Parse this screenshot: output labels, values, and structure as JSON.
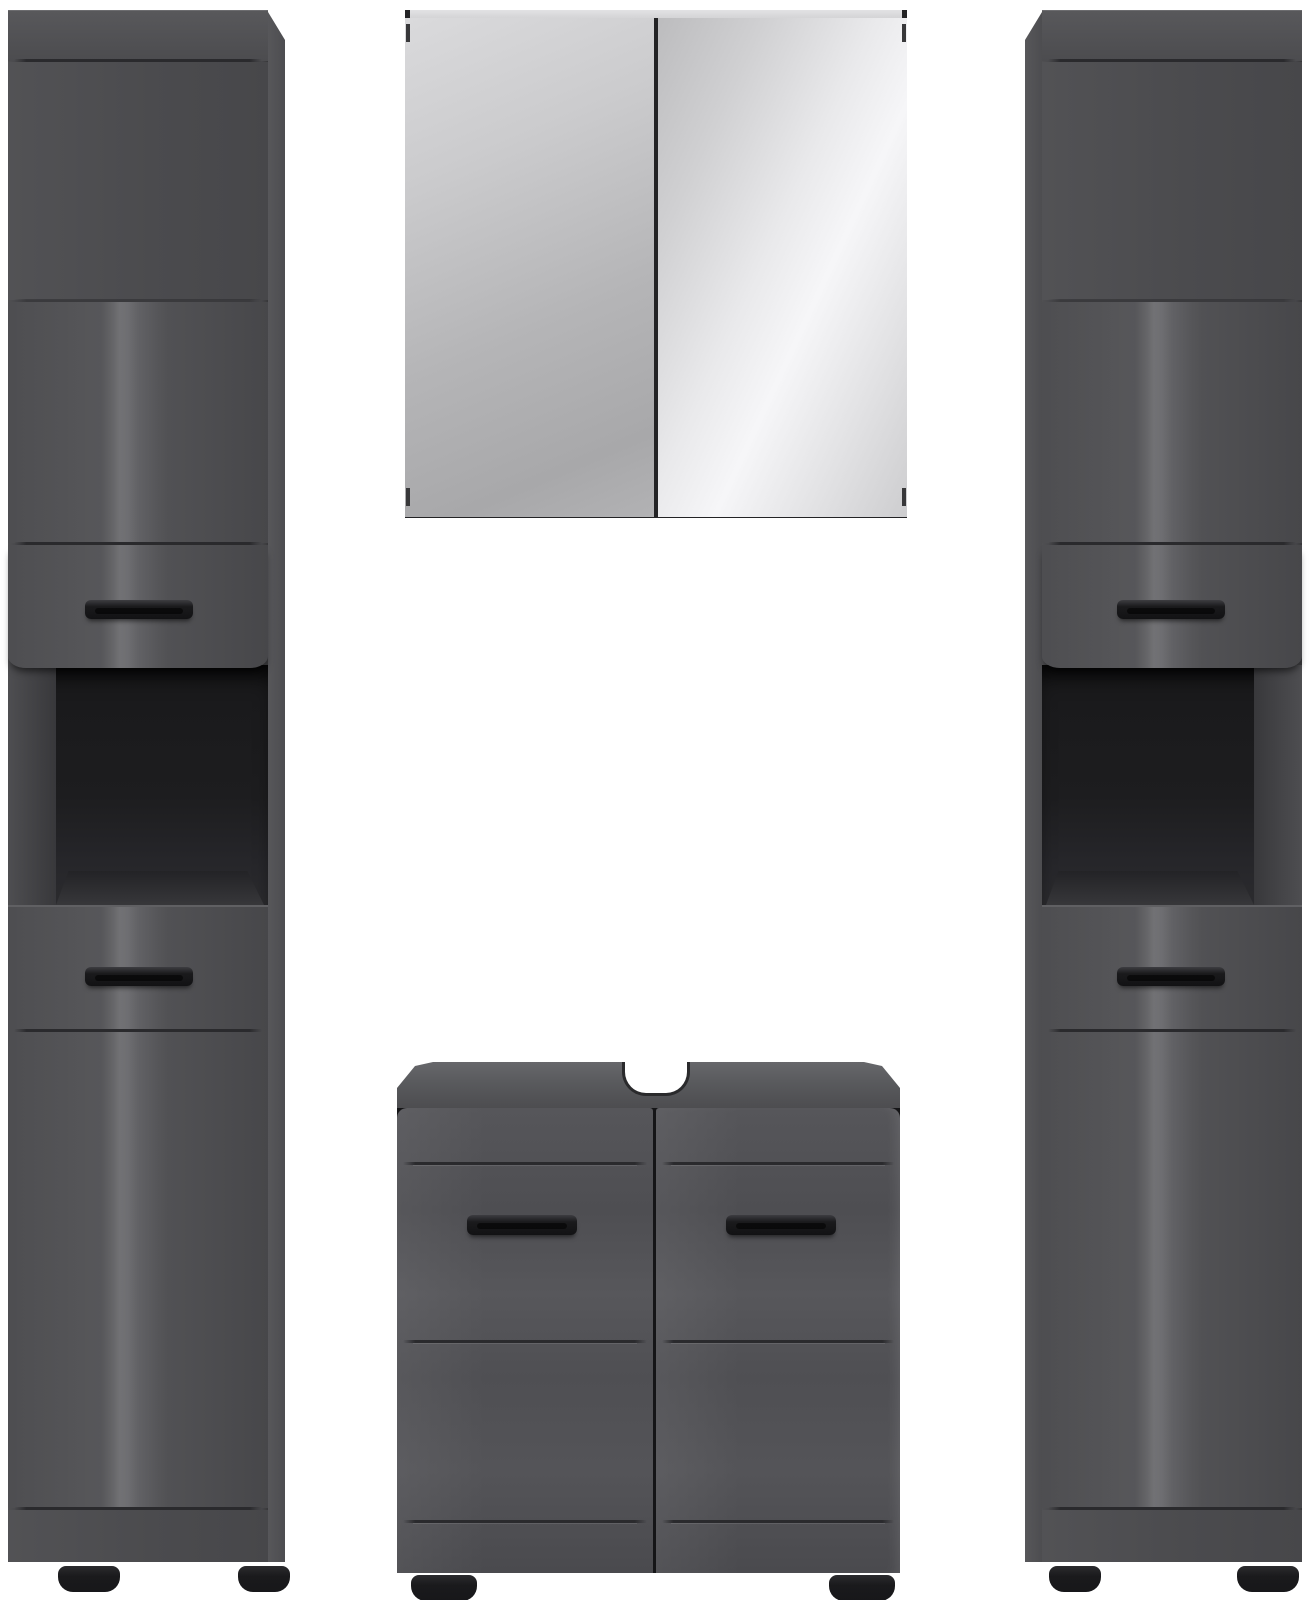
{
  "meta": {
    "title": "Product image: three-piece dark grey high-gloss bathroom furniture set with mirror cabinet",
    "background": "#ffffff"
  },
  "colors": {
    "bg": "#ffffff",
    "front_matte": "#4b4b4e",
    "front_dark": "#47474a",
    "side_panel": "#57575a",
    "groove_line": "#2a2a2d",
    "carcass_wall": "#4e4e51",
    "niche_dark": "#19191b",
    "niche_floor": "#37373a",
    "handle_dark": "#121214",
    "handle_light": "#3d3d41",
    "foot": "#17171a",
    "door_edge": "#2a2a2c",
    "sink_top_light": "#67676b",
    "top_strip": "#d4d4d6",
    "mirror_gap": "#232325",
    "mirror_left_light": "#dadadc",
    "mirror_left_dark": "#a8a8aa",
    "mirror_right_light": "#f6f6f8",
    "mirror_right_dark": "#bcbcbe"
  },
  "items": [
    {
      "id": "tall-cabinet-left",
      "name": "Tall bathroom cabinet, left, dark grey gloss: upper door with bar handle, open shelf niche, drawer front and lower door with bar handle, two black feet"
    },
    {
      "id": "mirror-cabinet",
      "name": "Wall mirror cabinet with two mirrored doors"
    },
    {
      "id": "washbasin-cabinet",
      "name": "Washbasin base cabinet with siphon cut-out, two doors with black bar handles and two black feet"
    },
    {
      "id": "tall-cabinet-right",
      "name": "Tall bathroom cabinet, right, dark grey gloss: upper door with bar handle, open shelf niche, drawer front and lower door with bar handle, two black feet"
    }
  ]
}
